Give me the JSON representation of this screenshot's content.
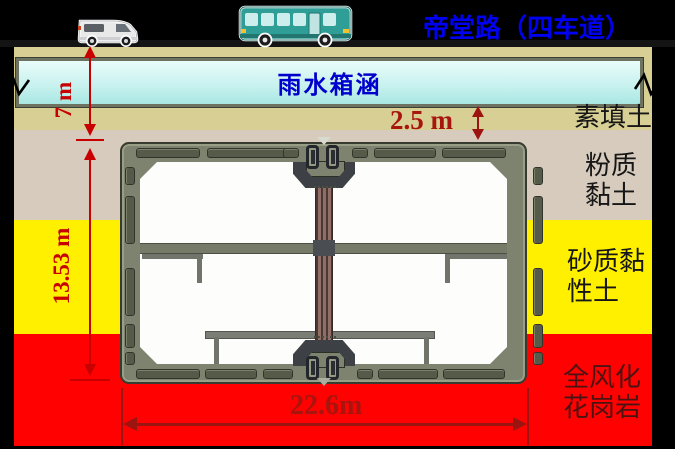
{
  "header": {
    "road_label": "帝堂路（四车道）"
  },
  "culvert": {
    "label": "雨水箱涵"
  },
  "dimensions": {
    "culvert_depth": "7 m",
    "structure_depth": "13.53 m",
    "cover_thickness": "2.5 m",
    "structure_width": "22.6m"
  },
  "soil_layers": [
    {
      "label": "素填土",
      "lines": [
        "素填土"
      ],
      "color": "#d7cf93"
    },
    {
      "label": "粉质黏土",
      "lines": [
        "粉质",
        "黏土"
      ],
      "color": "#d6cbbc"
    },
    {
      "label": "砂质黏性土",
      "lines": [
        "砂质黏",
        "性土"
      ],
      "color": "#fff000"
    },
    {
      "label": "全风化花岗岩",
      "lines": [
        "全风化",
        "花岗岩"
      ],
      "color": "#fe0100"
    }
  ],
  "vehicles": [
    {
      "name": "van"
    },
    {
      "name": "bus"
    }
  ],
  "colors": {
    "road_title_blue": "#0000f2",
    "culvert_label_blue": "#0000cd",
    "dimension_red": "#c80000",
    "dimension_dark_red": "#9c1410",
    "structure_wall_olive": "#7e8370",
    "background_black": "#000000"
  }
}
